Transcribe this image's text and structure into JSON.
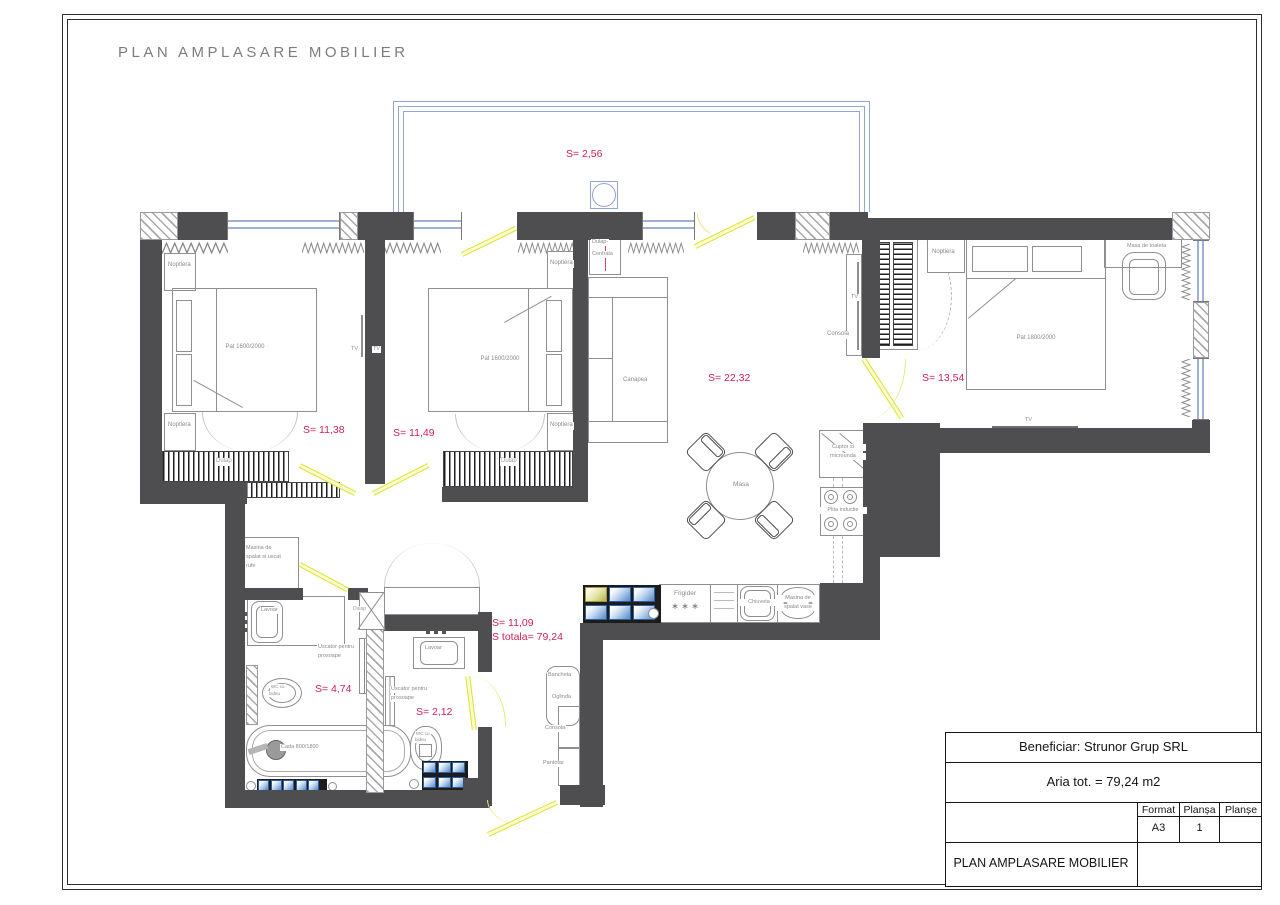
{
  "sheet": {
    "title": "PLAN  AMPLASARE  MOBILIER"
  },
  "areas": {
    "balcony": "S= 2,56",
    "bedroom1": "S= 11,38",
    "bedroom2": "S= 11,49",
    "living": "S= 22,32",
    "master": "S= 13,54",
    "hall": "S= 11,09",
    "hall_total": "S totala= 79,24",
    "bathroom": "S= 4,74",
    "wc": "S= 2,12"
  },
  "labels": {
    "noptiera": "Noptiera",
    "pat1600": "Pat 1600/2000",
    "pat1800": "Pat 1800/2000",
    "tv": "TV",
    "dulap": "Dulap",
    "dulap2": "Dulap-",
    "centrala": "Centrala",
    "canapea": "Canapea",
    "consola": "Consola",
    "masa": "Masa",
    "masa_toaleta": "Masa de toaleta",
    "cuptor1": "Cuptor si",
    "cuptor2": "microunda",
    "plita": "Plita inductie",
    "frigider": "Frigider",
    "stars": "∗ ∗ ∗",
    "chiuveta": "Chiuveta",
    "msv1": "Masina de",
    "msv2": "spalat vase",
    "bancheta": "Bancheta",
    "oglinda": "Oglinda",
    "pantofar": "Pantofar",
    "masina1": "Masina de",
    "masina2": "spalat si uscat",
    "masina3": "rufe",
    "lavoar": "Lavoar",
    "uscator1": "Uscator pentru",
    "uscator2": "prosoape",
    "wc1": "WC cu",
    "wc2": "bideu",
    "cada": "Cada 800/1800"
  },
  "titleblock": {
    "beneficiar": "Beneficiar: Strunor Grup SRL",
    "aria": "Aria tot. = 79,24 m2",
    "format_label": "Format",
    "format_value": "A3",
    "plansa_label": "Planșa",
    "plansa_value": "1",
    "planse_label": "Planșe",
    "planse_value": "",
    "plan_name": "PLAN AMPLASARE MOBILIER"
  },
  "colors": {
    "wall": "#4e4e50",
    "area_label": "#cf2257",
    "door": "#dde233",
    "window": "#9db1d6"
  }
}
